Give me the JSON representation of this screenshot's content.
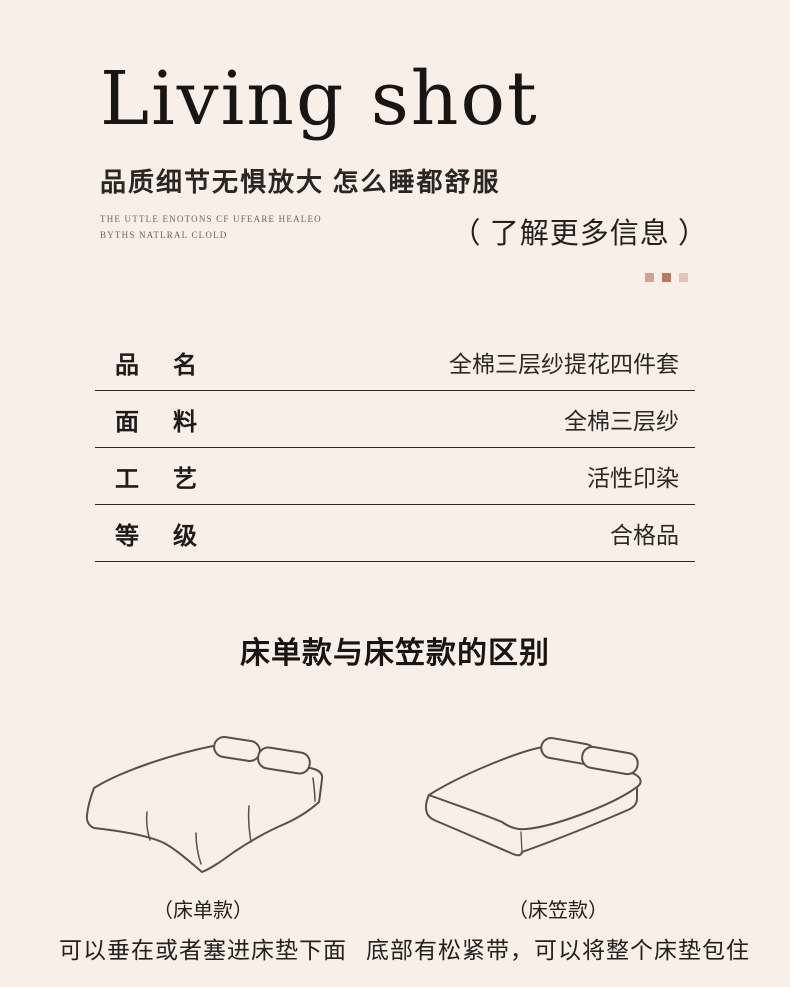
{
  "colors": {
    "background": "#f8efe9",
    "ink": "#1e1b18",
    "table_line": "#2b2723",
    "sketch_stroke": "#55514b"
  },
  "header": {
    "title": "Living shot",
    "subtitle": "品质细节无惧放大 怎么睡都舒服",
    "note_line1": "THE UTTLE ENOTONS CF UFEARE HEALEO",
    "note_line2": "BYTHS NATLRAL CLOLD"
  },
  "learn_more": {
    "label": "（ 了解更多信息 ）",
    "squares": [
      "#d0a294",
      "#b97a62",
      "#e4c4ba"
    ]
  },
  "spec_table": {
    "rows": [
      {
        "label": "品名",
        "value": "全棉三层纱提花四件套"
      },
      {
        "label": "面料",
        "value": "全棉三层纱"
      },
      {
        "label": "工艺",
        "value": "活性印染"
      },
      {
        "label": "等级",
        "value": "合格品"
      }
    ]
  },
  "comparison": {
    "title": "床单款与床笠款的区别",
    "figures": [
      {
        "variant": "（床单款）",
        "desc": "可以垂在或者塞进床垫下面",
        "icon": "flat-sheet-bed-illustration"
      },
      {
        "variant": "（床笠款）",
        "desc": "底部有松紧带，可以将整个床垫包住",
        "icon": "fitted-sheet-bed-illustration"
      }
    ]
  }
}
